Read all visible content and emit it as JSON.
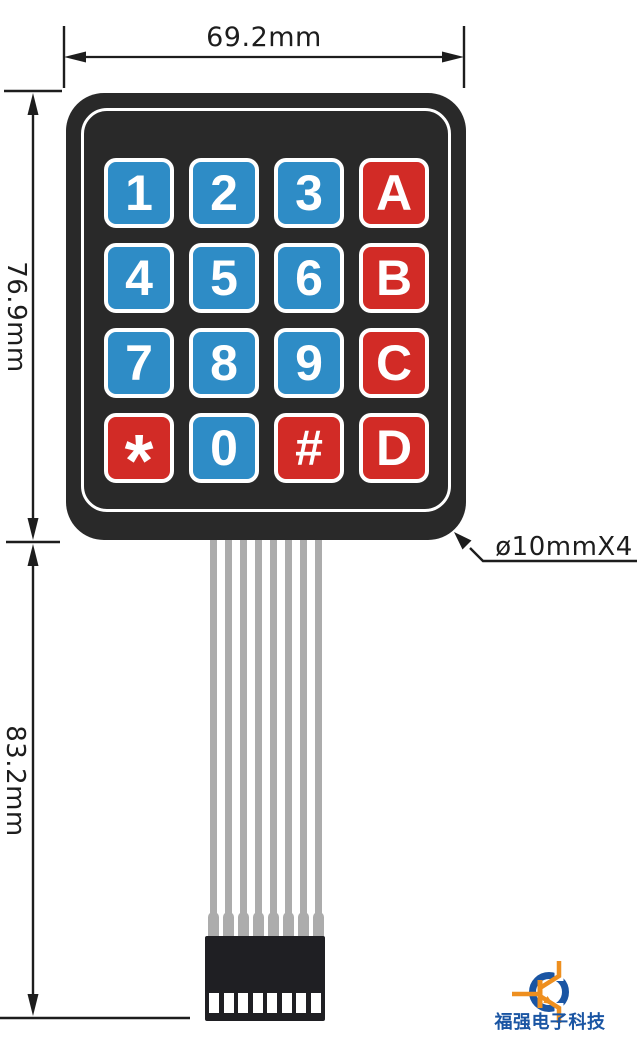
{
  "annotations": {
    "width": "69.2mm",
    "height": "76.9mm",
    "cable_length": "83.2mm",
    "button_spec": "ø10mmX4"
  },
  "keypad": {
    "rows": 4,
    "cols": 4,
    "keys": [
      {
        "label": "1",
        "type": "blue"
      },
      {
        "label": "2",
        "type": "blue"
      },
      {
        "label": "3",
        "type": "blue"
      },
      {
        "label": "A",
        "type": "red"
      },
      {
        "label": "4",
        "type": "blue"
      },
      {
        "label": "5",
        "type": "blue"
      },
      {
        "label": "6",
        "type": "blue"
      },
      {
        "label": "B",
        "type": "red"
      },
      {
        "label": "7",
        "type": "blue"
      },
      {
        "label": "8",
        "type": "blue"
      },
      {
        "label": "9",
        "type": "blue"
      },
      {
        "label": "C",
        "type": "red"
      },
      {
        "label": "*",
        "type": "red"
      },
      {
        "label": "0",
        "type": "blue"
      },
      {
        "label": "#",
        "type": "red"
      },
      {
        "label": "D",
        "type": "red"
      }
    ]
  },
  "cable": {
    "wire_count": 8
  },
  "logo": {
    "text": "福强电子科技"
  },
  "colors": {
    "key_blue": "#2E8CC6",
    "key_red": "#D22B26",
    "body": "#292929",
    "cable_grey": "#ACACAC",
    "connector": "#1F1F23",
    "dim_line": "#1d1d1d",
    "logo_blue": "#1A55A3",
    "logo_orange": "#EE8F1F"
  }
}
